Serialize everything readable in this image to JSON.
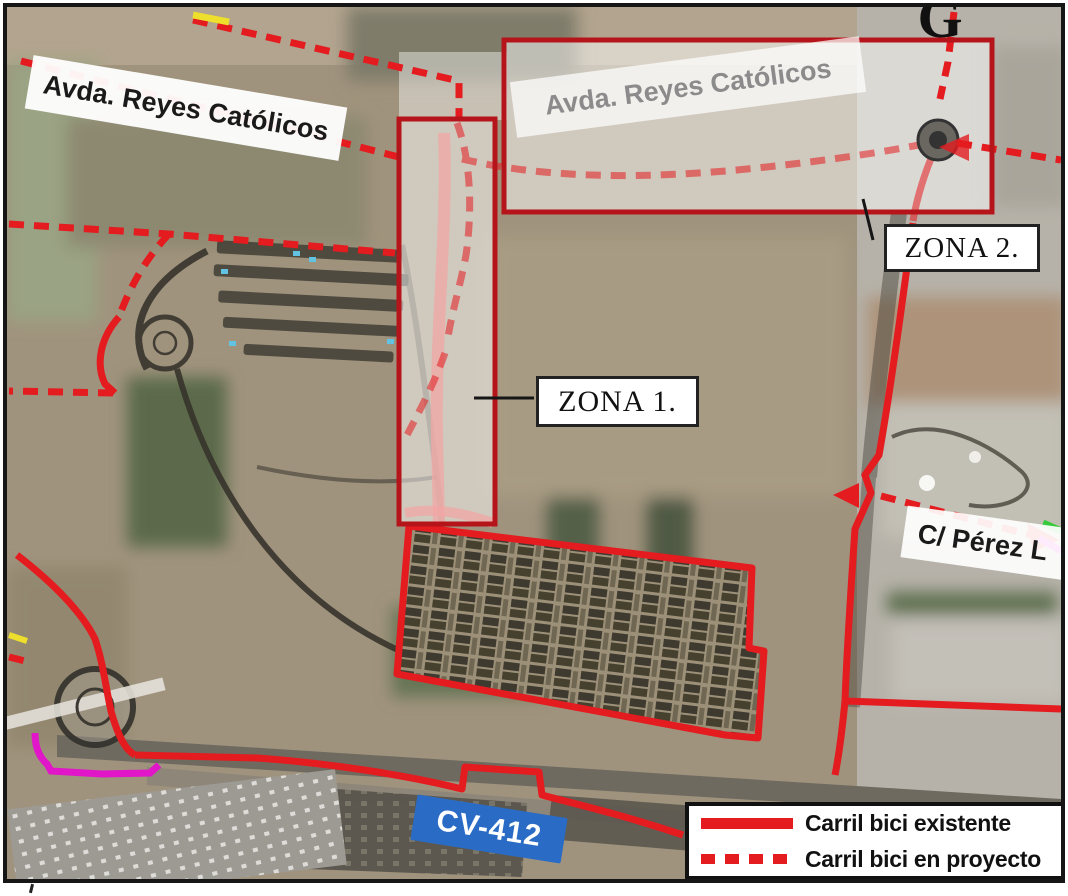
{
  "labels": {
    "avenue_top_left": "Avda. Reyes Católicos",
    "avenue_zona2": "Avda. Reyes Católicos",
    "zona_1": "ZONA 1.",
    "zona_2": "ZONA 2.",
    "street_perez": "C/ Pérez L",
    "road_sign_cv412": "CV-412",
    "partial_letter_top_right": "G"
  },
  "legend": {
    "items": [
      {
        "label": "Carril bici existente",
        "line_style": "solid"
      },
      {
        "label": "Carril bici en proyecto",
        "line_style": "dashed"
      }
    ]
  },
  "colors": {
    "bike_red": "#e41b1f",
    "zone_outline_red": "#b5151a",
    "magenta_lane": "#e016c8",
    "yellow_lane": "#eedf2c",
    "green_lane": "#35c93b",
    "sign_blue": "#2a6cc5",
    "ink": "#141414"
  }
}
